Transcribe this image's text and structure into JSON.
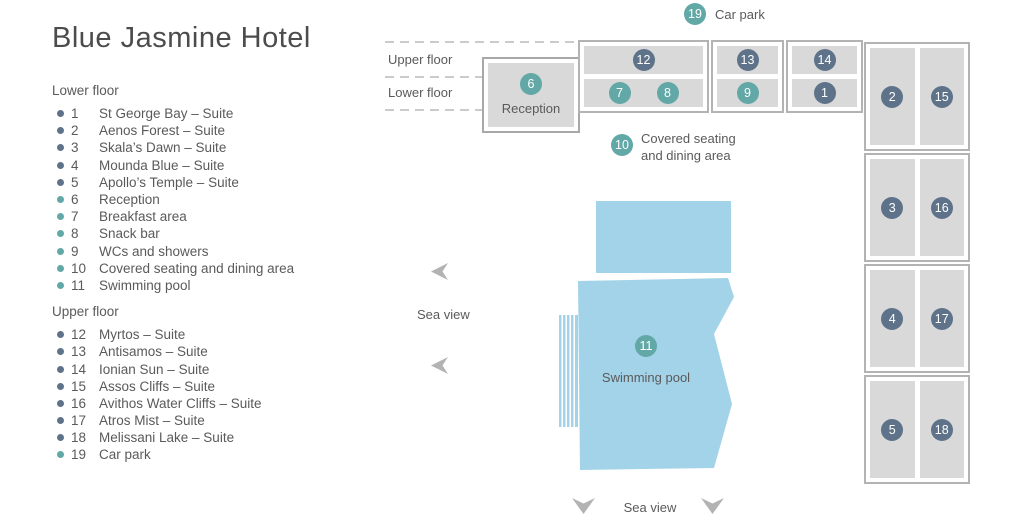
{
  "title": "Blue Jasmine Hotel",
  "colors": {
    "suite_accent": "#5e7389",
    "facility_accent": "#62a8a6",
    "pool_fill": "#a3d3e8",
    "cell_fill": "#d9d9d9",
    "border_gray": "#b3b3b3",
    "text_gray": "#5a5a5a"
  },
  "legend": {
    "lower": {
      "heading": "Lower floor",
      "items": [
        {
          "num": "1",
          "label": "St George Bay – Suite",
          "category": "suite"
        },
        {
          "num": "2",
          "label": "Aenos Forest – Suite",
          "category": "suite"
        },
        {
          "num": "3",
          "label": "Skala’s Dawn – Suite",
          "category": "suite"
        },
        {
          "num": "4",
          "label": "Mounda Blue – Suite",
          "category": "suite"
        },
        {
          "num": "5",
          "label": "Apollo’s Temple – Suite",
          "category": "suite"
        },
        {
          "num": "6",
          "label": "Reception",
          "category": "facility"
        },
        {
          "num": "7",
          "label": "Breakfast area",
          "category": "facility"
        },
        {
          "num": "8",
          "label": "Snack bar",
          "category": "facility"
        },
        {
          "num": "9",
          "label": "WCs and showers",
          "category": "facility"
        },
        {
          "num": "10",
          "label": "Covered seating and dining area",
          "category": "facility"
        },
        {
          "num": "11",
          "label": "Swimming pool",
          "category": "facility"
        }
      ]
    },
    "upper": {
      "heading": "Upper floor",
      "items": [
        {
          "num": "12",
          "label": "Myrtos – Suite",
          "category": "suite"
        },
        {
          "num": "13",
          "label": "Antisamos – Suite",
          "category": "suite"
        },
        {
          "num": "14",
          "label": "Ionian Sun – Suite",
          "category": "suite"
        },
        {
          "num": "15",
          "label": "Assos Cliffs – Suite",
          "category": "suite"
        },
        {
          "num": "16",
          "label": "Avithos Water Cliffs – Suite",
          "category": "suite"
        },
        {
          "num": "17",
          "label": "Atros Mist – Suite",
          "category": "suite"
        },
        {
          "num": "18",
          "label": "Melissani Lake – Suite",
          "category": "suite"
        },
        {
          "num": "19",
          "label": "Car park",
          "category": "facility"
        }
      ]
    }
  },
  "map": {
    "car_park": {
      "num": "19",
      "label": "Car park"
    },
    "floor_labels": {
      "upper": "Upper floor",
      "lower": "Lower floor"
    },
    "reception": {
      "num": "6",
      "label": "Reception"
    },
    "buildings_top_row": [
      {
        "upper_nums": [
          "12"
        ],
        "lower_nums": [
          "7",
          "8"
        ]
      },
      {
        "upper_nums": [
          "13"
        ],
        "lower_nums": [
          "9"
        ]
      },
      {
        "upper_nums": [
          "14"
        ],
        "lower_nums": [
          "1"
        ]
      }
    ],
    "buildings_right_column": [
      {
        "left_num": "2",
        "right_num": "15"
      },
      {
        "left_num": "3",
        "right_num": "16"
      },
      {
        "left_num": "4",
        "right_num": "17"
      },
      {
        "left_num": "5",
        "right_num": "18"
      }
    ],
    "covered_area": {
      "num": "10",
      "label_lines": [
        "Covered seating",
        "and dining area"
      ]
    },
    "pool": {
      "num": "11",
      "label": "Swimming pool"
    },
    "sea_view_left_label": "Sea view",
    "sea_view_bottom_label": "Sea view"
  }
}
